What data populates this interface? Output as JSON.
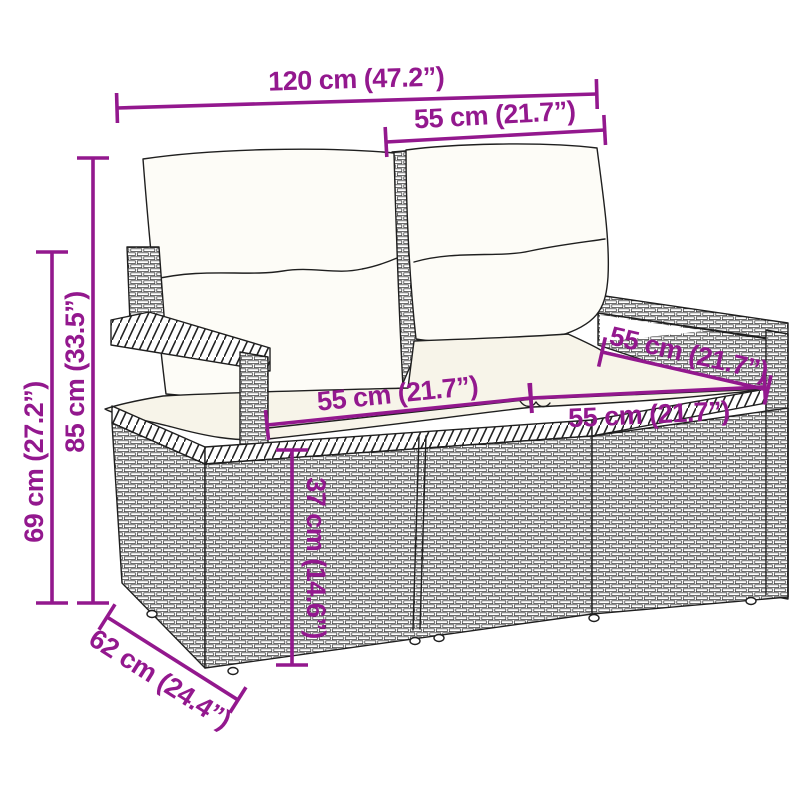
{
  "figure": {
    "description": "Dimension diagram of a poly rattan 2-seater garden sofa with back and seat cushions"
  },
  "colors": {
    "dimension_line": "#93188E",
    "line_art": "#1f1f1f",
    "background": "#ffffff",
    "cushion_fill": "#fdfcf7",
    "seat_cushion_fill": "#f7f4e9"
  },
  "dims": {
    "overall_width": {
      "label": "120 cm (47.2”)",
      "cm": 120,
      "inches": 47.2
    },
    "backrest_width": {
      "label": "55 cm (21.7”)",
      "cm": 55,
      "inches": 21.7
    },
    "total_height": {
      "label": "85 cm (33.5”)",
      "cm": 85,
      "inches": 33.5
    },
    "armrest_height": {
      "label": "69 cm (27.2”)",
      "cm": 69,
      "inches": 27.2
    },
    "seat_width_left": {
      "label": "55 cm (21.7”)",
      "cm": 55,
      "inches": 21.7
    },
    "seat_width_right": {
      "label": "55 cm (21.7”)",
      "cm": 55,
      "inches": 21.7
    },
    "seat_depth": {
      "label": "55 cm (21.7”)",
      "cm": 55,
      "inches": 21.7
    },
    "seat_height": {
      "label": "37 cm (14.6”)",
      "cm": 37,
      "inches": 14.6
    },
    "overall_depth": {
      "label": "62 cm (24.4”)",
      "cm": 62,
      "inches": 24.4
    }
  }
}
